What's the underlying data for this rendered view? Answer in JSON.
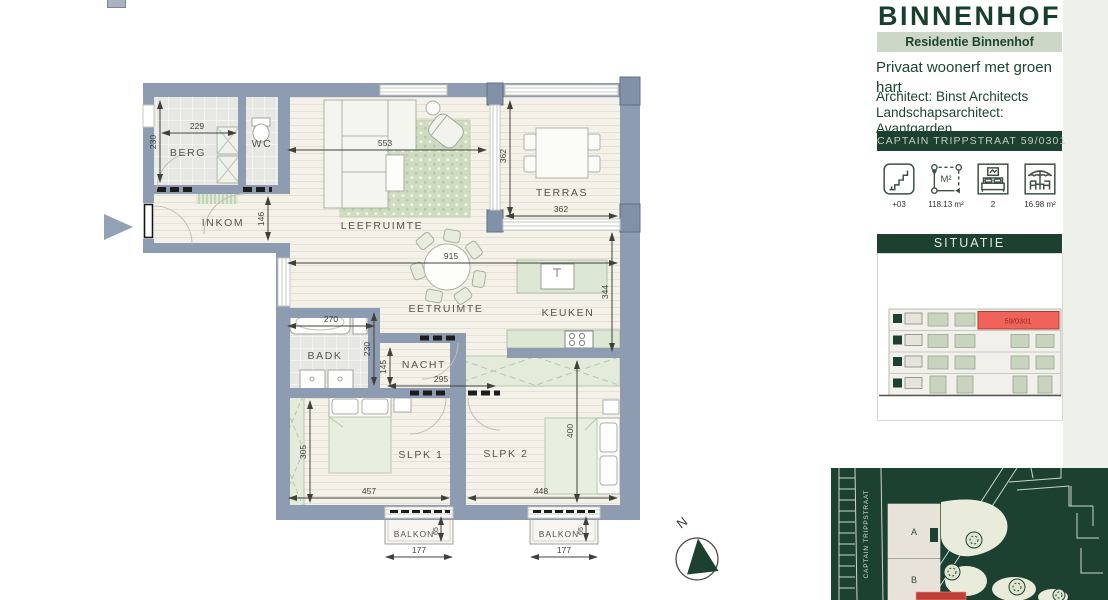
{
  "header": {
    "title": "BINNENHOF",
    "subtitle": "Residentie Binnenhof",
    "tagline": "Privaat woonerf met groen hart",
    "architect_line1": "Architect: Binst Architects",
    "architect_line2": "Landschapsarchitect: Avantgarden",
    "address_bar": "CAPTAIN TRIPPSTRAAT 59/0301"
  },
  "stats": [
    {
      "icon": "stairs-icon",
      "label": "+03"
    },
    {
      "icon": "area-icon",
      "label": "118.13 m²"
    },
    {
      "icon": "bedrooms-icon",
      "label": "2"
    },
    {
      "icon": "terrace-icon",
      "label": "16.98 m²"
    }
  ],
  "situatie": {
    "title": "SITUATIE",
    "highlight_unit": "59/0301"
  },
  "map": {
    "street": "CAPTAIN TRIPPSTRAAT",
    "block_a": "A",
    "block_b": "B"
  },
  "plan": {
    "compass_label": "N",
    "rooms": {
      "berg": "BERG",
      "wc": "WC",
      "inkom": "INKOM",
      "leefruimte": "LEEFRUIMTE",
      "terras": "TERRAS",
      "eetruimte": "EETRUIMTE",
      "keuken": "KEUKEN",
      "badk": "BADK",
      "nacht": "NACHT",
      "slpk1": "SLPK 1",
      "slpk2": "SLPK 2",
      "balkon1": "BALKON",
      "balkon2": "BALKON"
    },
    "dimensions": {
      "berg_w": "229",
      "berg_h": "230",
      "inkom_h": "146",
      "leef_w": "553",
      "terras_h": "362",
      "terras_w": "362",
      "eet_w": "915",
      "keuken_h": "344",
      "badk_w": "270",
      "badk_h": "230",
      "nacht_h": "145",
      "nacht_w": "295",
      "slpk1_h": "305",
      "slpk1_w": "457",
      "slpk2_w": "448",
      "slpk2_h": "400",
      "balkon1_w": "177",
      "balkon1_d": "65",
      "balkon2_w": "177",
      "balkon2_d": "65"
    }
  },
  "colors": {
    "brand_green": "#1c4130",
    "subtitle_bg": "#ccd7c8",
    "wall_grey": "#8e9cb1",
    "floor_cream": "#f4f1e9",
    "furniture_sage": "#dfe9d8",
    "highlight_red": "#f0625a",
    "map_bg": "#1c4130"
  }
}
